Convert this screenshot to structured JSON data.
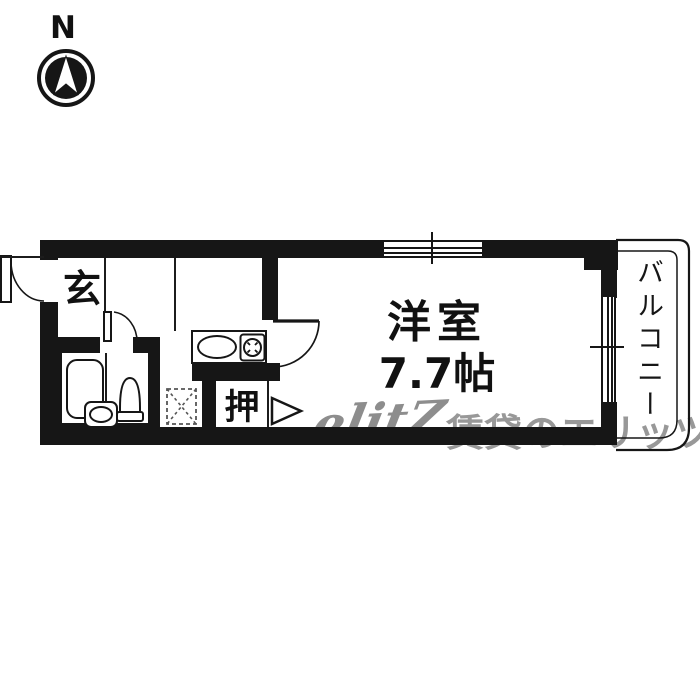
{
  "compass": {
    "north_label": "N"
  },
  "plan": {
    "entrance_label": "玄",
    "room_label": "洋室",
    "room_area": "7.7帖",
    "closet_label": "押",
    "balcony_label": "バルコニー"
  },
  "watermark": {
    "logo": "elitZ",
    "caption": "賃貸のエリッツ"
  },
  "colors": {
    "wall": "#161616",
    "background": "#ffffff",
    "watermark_gray": "#989898"
  }
}
